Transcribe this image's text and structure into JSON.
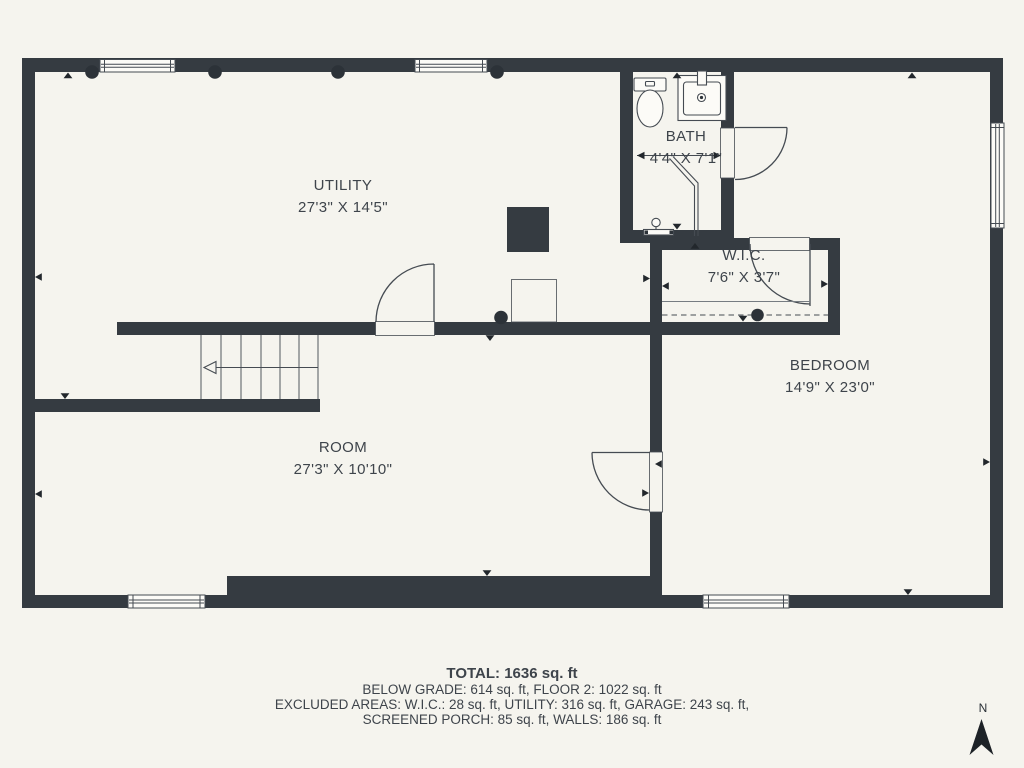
{
  "plan": {
    "rooms": [
      {
        "name": "UTILITY",
        "dims": "27'3\" X 14'5\""
      },
      {
        "name": "BATH",
        "dims": "4'4\" X 7'1\""
      },
      {
        "name": "W.I.C.",
        "dims": "7'6\" X 3'7\""
      },
      {
        "name": "BEDROOM",
        "dims": "14'9\" X 23'0\""
      },
      {
        "name": "ROOM",
        "dims": "27'3\" X 10'10\""
      }
    ],
    "summary": {
      "total": "TOTAL: 1636 sq. ft",
      "line2": "BELOW GRADE: 614 sq. ft, FLOOR 2: 1022 sq. ft",
      "line3": "EXCLUDED AREAS: W.I.C.: 28 sq. ft, UTILITY: 316 sq. ft, GARAGE: 243 sq. ft,",
      "line4": "SCREENED PORCH: 85 sq. ft, WALLS: 186 sq. ft"
    },
    "compass": {
      "label": "N"
    },
    "colors": {
      "background": "#f5f4ee",
      "wall": "#353b41",
      "line": "#454b52",
      "text": "#3e444b"
    }
  }
}
